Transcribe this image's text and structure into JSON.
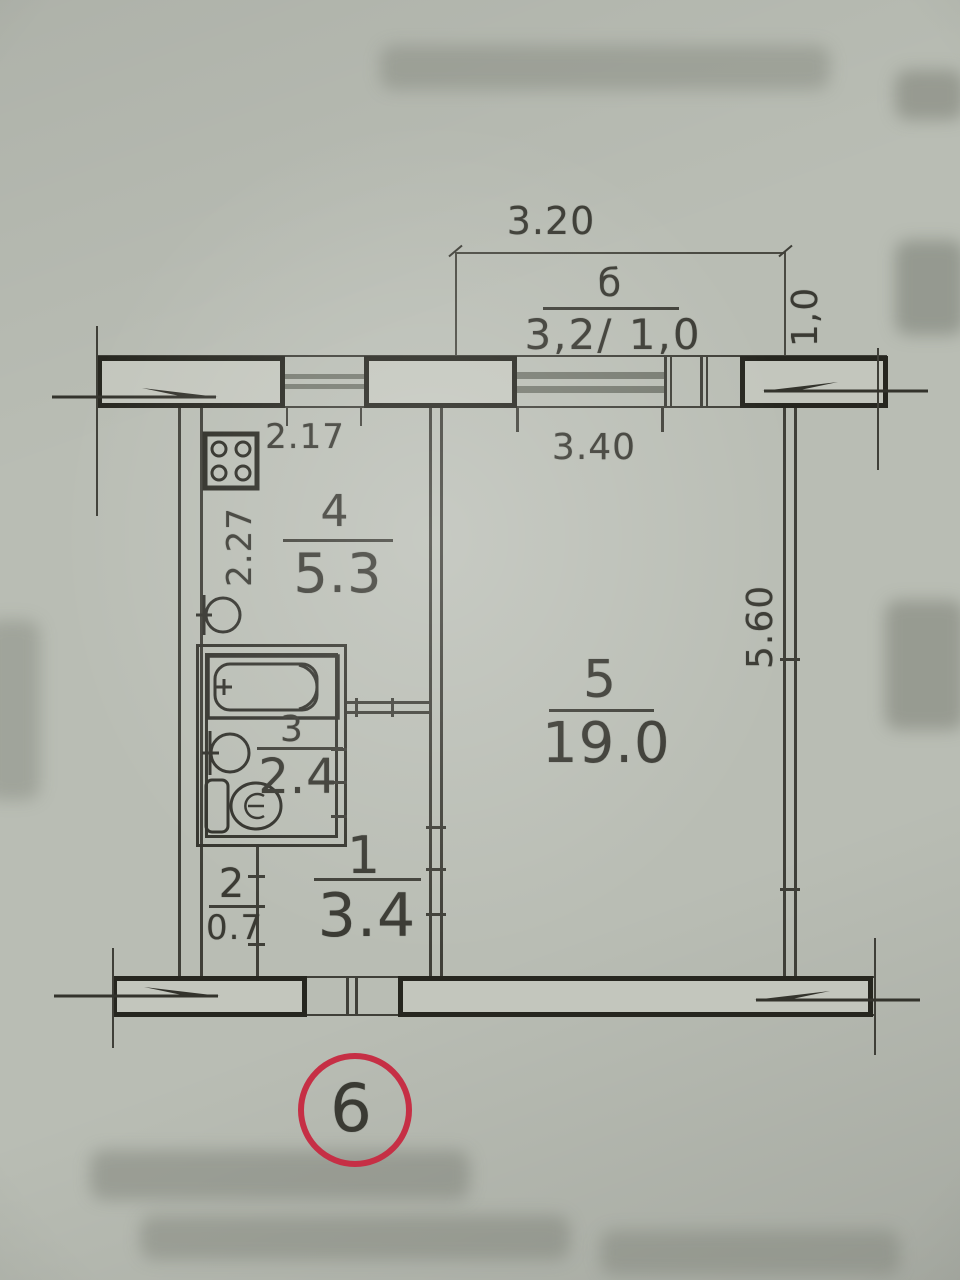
{
  "plan": {
    "circled_unit_number": "6",
    "balcony": {
      "width_dim": "3.20",
      "symbol": "б",
      "size_dim": "3,2/ 1,0",
      "depth_dim": "1,0"
    },
    "dims": {
      "kitchen_width": "2.17",
      "kitchen_depth": "2.27",
      "living_width": "3.40",
      "living_depth": "5.60"
    },
    "rooms": {
      "hall": {
        "num": "1",
        "area": "3.4"
      },
      "closet": {
        "num": "2",
        "area": "0.7"
      },
      "bath": {
        "num": "3",
        "area": "2.4"
      },
      "kitchen": {
        "num": "4",
        "area": "5.3"
      },
      "living": {
        "num": "5",
        "area": "19.0"
      }
    },
    "colors": {
      "paper": "#b9bdb4",
      "ink": "#3a3a33",
      "window_gray": "#767a70",
      "circle_red": "#c62f45"
    }
  }
}
